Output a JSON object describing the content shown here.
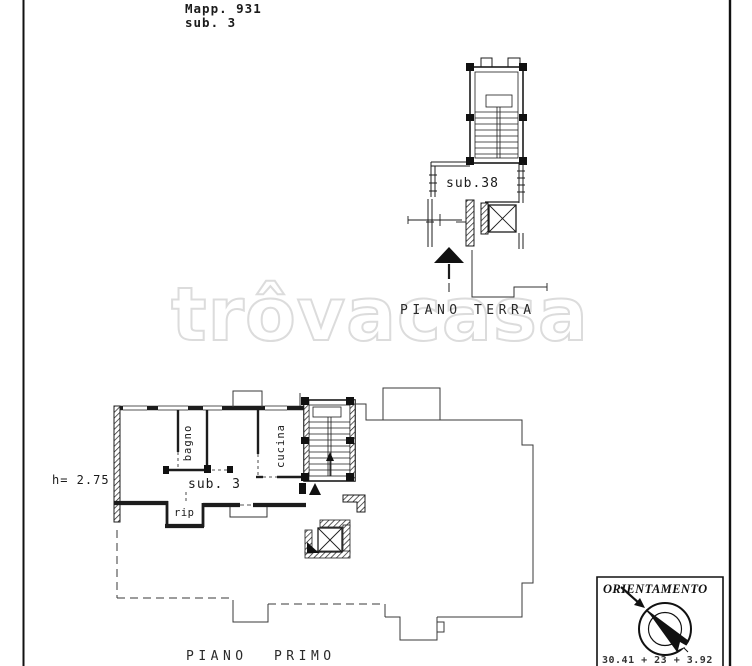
{
  "page": {
    "background": "#ffffff",
    "ink_color": "#1c1c1c",
    "watermark_color": "#dcdcdc"
  },
  "header": {
    "map_ref": "Mapp. 931",
    "sub_ref": "sub. 3"
  },
  "watermark": {
    "text": "trôvacasa"
  },
  "ground_floor": {
    "unit_label": "sub.38",
    "caption": "PIANO TERRA"
  },
  "first_floor": {
    "caption": "PIANO PRIMO",
    "unit_label": "sub. 3",
    "height_note": "h= 2.75",
    "rooms": {
      "bathroom": "bagno",
      "kitchen": "cucina",
      "storage": "rip"
    }
  },
  "orientation": {
    "title": "ORIENTAMENTO",
    "footnote_fragment": "30.41 + 23 + 3.92"
  }
}
